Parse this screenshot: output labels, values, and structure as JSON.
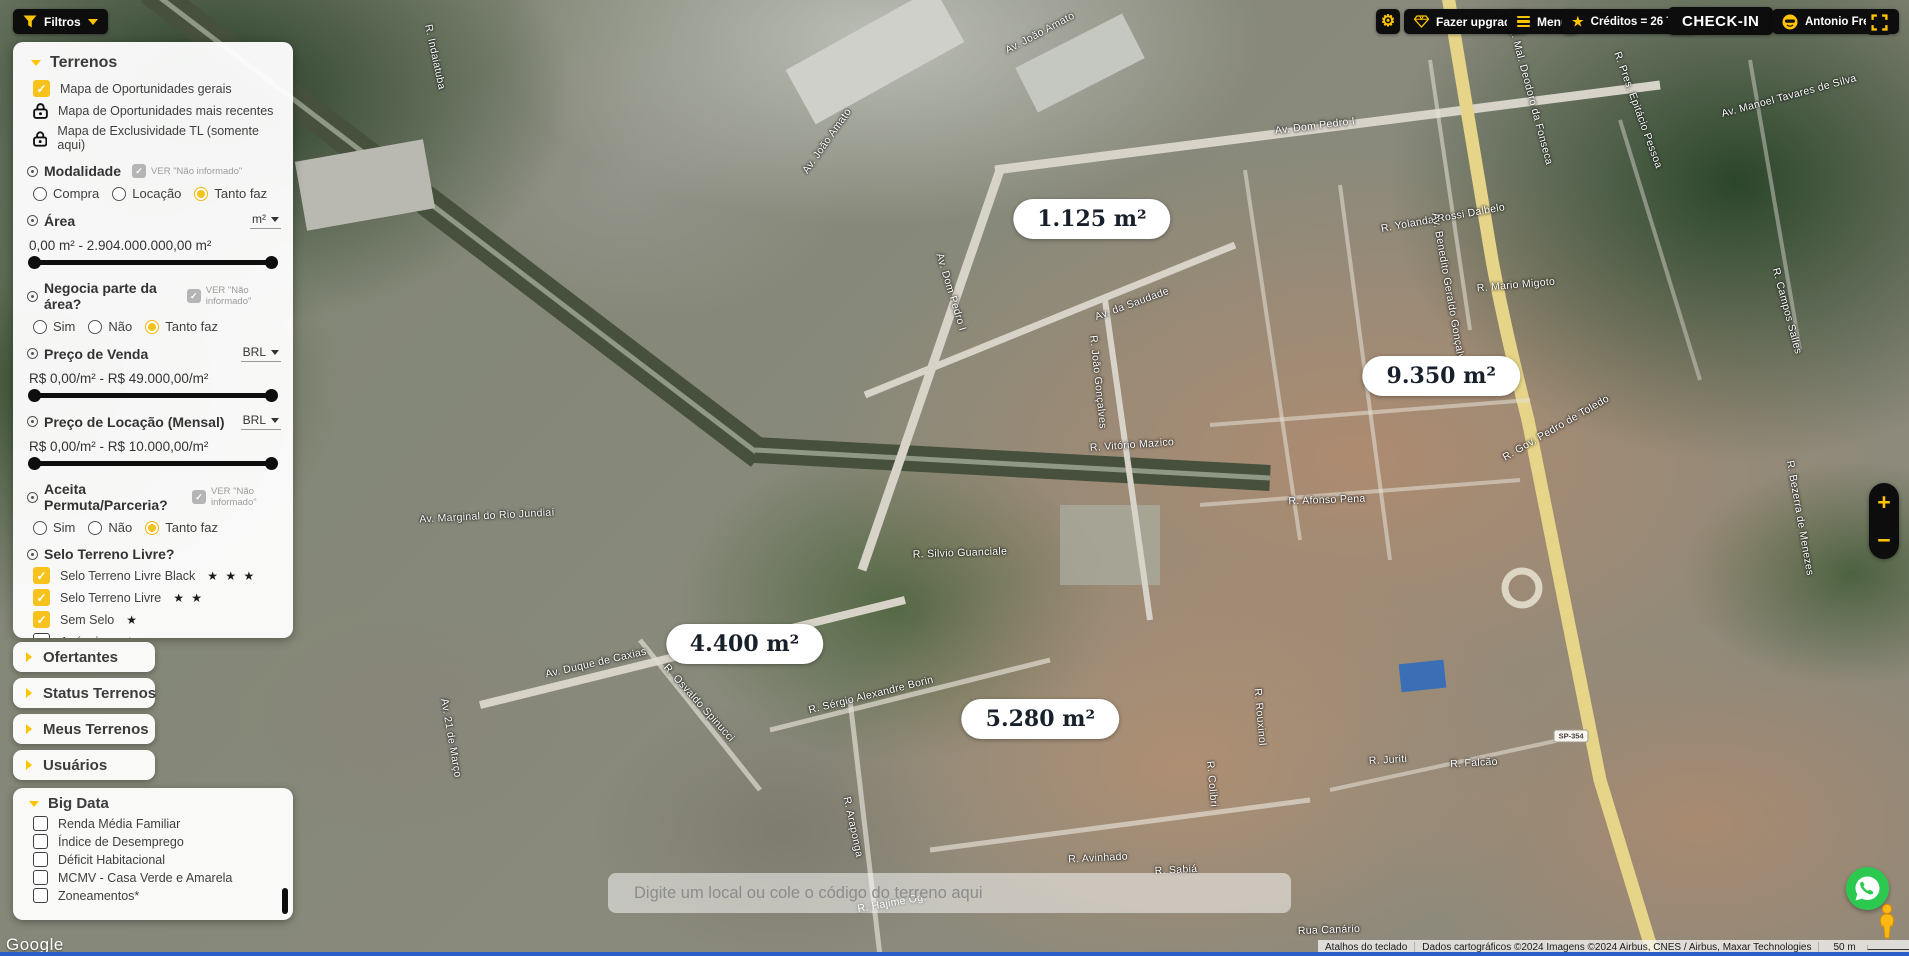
{
  "topbar": {
    "filtros_label": "Filtros",
    "fazer_upgrade_label": "Fazer upgrade",
    "menu_label": "Menu",
    "creditos_label": "Créditos = 26 TLs",
    "checkin_label": "CHECK-IN",
    "user_name": "Antonio Freitas"
  },
  "filters_panel": {
    "title": "Terrenos",
    "map_layers": [
      "Mapa de Oportunidades gerais",
      "Mapa de Oportunidades mais recentes",
      "Mapa de Exclusividade TL (somente aqui)"
    ],
    "ver_nao_informado_label": "VER \"Não informado\"",
    "modalidade": {
      "title": "Modalidade",
      "opt1": "Compra",
      "opt2": "Locação",
      "opt3": "Tanto faz",
      "selected": "Tanto faz"
    },
    "area": {
      "title": "Área",
      "unit": "m²",
      "range": "0,00 m² - 2.904.000.000,00 m²"
    },
    "negocia": {
      "title": "Negocia parte da área?",
      "opt1": "Sim",
      "opt2": "Não",
      "opt3": "Tanto faz",
      "selected": "Tanto faz"
    },
    "preco_venda": {
      "title": "Preço de Venda",
      "currency": "BRL",
      "range": "R$ 0,00/m² - R$ 49.000,00/m²"
    },
    "preco_locacao": {
      "title": "Preço de Locação (Mensal)",
      "currency": "BRL",
      "range": "R$ 0,00/m² - R$ 10.000,00/m²"
    },
    "permuta": {
      "title": "Aceita Permuta/Parceria?",
      "opt1": "Sim",
      "opt2": "Não",
      "opt3": "Tanto faz",
      "selected": "Tanto faz"
    },
    "selo": {
      "title": "Selo Terreno Livre?",
      "opt_black": "Selo Terreno Livre Black",
      "stars_black": "★ ★ ★",
      "opt_livre": "Selo Terreno Livre",
      "stars_livre": "★ ★",
      "opt_sem": "Sem Selo",
      "stars_sem": "★",
      "opt_externos": "Anúncios externos"
    }
  },
  "accordions": {
    "a1": "Ofertantes",
    "a2": "Status Terrenos",
    "a3": "Meus Terrenos",
    "a4": "Usuários"
  },
  "big_data": {
    "title": "Big Data",
    "i1": "Renda Média Familiar",
    "i2": "Índice de Desemprego",
    "i3": "Déficit Habitacional",
    "i4": "MCMV - Casa Verde e Amarela",
    "i5": "Zoneamentos*"
  },
  "map": {
    "area_labels": [
      {
        "text": "1.125 m²",
        "x": 57.2,
        "y": 22.9
      },
      {
        "text": "9.350 m²",
        "x": 75.5,
        "y": 39.3
      },
      {
        "text": "4.400 m²",
        "x": 39.0,
        "y": 67.4
      },
      {
        "text": "5.280 m²",
        "x": 54.5,
        "y": 75.2
      }
    ],
    "road_labels": [
      {
        "text": "Av. João Amato",
        "x": 54.5,
        "y": 3.5,
        "rot": -28
      },
      {
        "text": "Av. João Amato",
        "x": 43.3,
        "y": 14.8,
        "rot": -55
      },
      {
        "text": "R. Indaiatuba",
        "x": 22.8,
        "y": 6.0,
        "rot": 78
      },
      {
        "text": "Av. Dom Pedro I",
        "x": 68.9,
        "y": 13.2,
        "rot": -7
      },
      {
        "text": "Av. Dom Pedro I",
        "x": 49.8,
        "y": 30.5,
        "rot": 73
      },
      {
        "text": "R. Yolanda Rossi Dalbelo",
        "x": 75.6,
        "y": 22.8,
        "rot": -10
      },
      {
        "text": "R. Mario Migoto",
        "x": 79.4,
        "y": 29.8,
        "rot": -5
      },
      {
        "text": "Av. da Saudade",
        "x": 59.3,
        "y": 31.8,
        "rot": -20
      },
      {
        "text": "R. João Gonçalves",
        "x": 57.5,
        "y": 40.0,
        "rot": 84
      },
      {
        "text": "R. Vitório Mazico",
        "x": 59.3,
        "y": 46.5,
        "rot": -4
      },
      {
        "text": "Av. Marginal do Rio Jundiaí",
        "x": 25.5,
        "y": 54.0,
        "rot": -3
      },
      {
        "text": "Av. Benedito Geraldo Gonçalves",
        "x": 75.9,
        "y": 30.5,
        "rot": 80
      },
      {
        "text": "R. Afonso Pena",
        "x": 69.5,
        "y": 52.3,
        "rot": -2
      },
      {
        "text": "R. Silvio Guanciale",
        "x": 50.3,
        "y": 57.8,
        "rot": -2
      },
      {
        "text": "Av. Duque de Caxias",
        "x": 31.2,
        "y": 69.3,
        "rot": -13
      },
      {
        "text": "R. Osvaldo Spinucci",
        "x": 36.6,
        "y": 73.5,
        "rot": 48
      },
      {
        "text": "R. Sérgio Alexandre Borin",
        "x": 45.6,
        "y": 72.7,
        "rot": -14
      },
      {
        "text": "Av. 21 de Março",
        "x": 23.6,
        "y": 77.2,
        "rot": 80
      },
      {
        "text": "R. Araponga",
        "x": 44.7,
        "y": 86.5,
        "rot": 78
      },
      {
        "text": "R. Avinhado",
        "x": 57.5,
        "y": 89.8,
        "rot": -3
      },
      {
        "text": "R. Sabiá",
        "x": 61.6,
        "y": 91.0,
        "rot": -3
      },
      {
        "text": "R. Juriti",
        "x": 72.7,
        "y": 79.5,
        "rot": -3
      },
      {
        "text": "R. Falcão",
        "x": 77.2,
        "y": 79.8,
        "rot": -3
      },
      {
        "text": "Rua Canário",
        "x": 69.6,
        "y": 97.3,
        "rot": -2
      },
      {
        "text": "R. Hajime Og.",
        "x": 46.7,
        "y": 94.5,
        "rot": -10
      },
      {
        "text": "R. Rouxinol",
        "x": 66.0,
        "y": 75.0,
        "rot": 85
      },
      {
        "text": "R. Colibri",
        "x": 63.5,
        "y": 82.0,
        "rot": 85
      },
      {
        "text": "R. Gov. Pedro de Toledo",
        "x": 81.5,
        "y": 44.8,
        "rot": -30
      },
      {
        "text": "R. Bezerra de Menezes",
        "x": 94.3,
        "y": 54.2,
        "rot": 80
      },
      {
        "text": "R. Campos Salles",
        "x": 93.6,
        "y": 32.5,
        "rot": 75
      },
      {
        "text": "Av. Manoel Tavares de Silva",
        "x": 93.7,
        "y": 10.0,
        "rot": -15
      },
      {
        "text": "R. Pres. Epitácio Pessoa",
        "x": 85.8,
        "y": 11.5,
        "rot": 70
      },
      {
        "text": "R. Mal. Deodoro da Fonseca",
        "x": 80.2,
        "y": 10.0,
        "rot": 75
      }
    ],
    "shield": "SP-354",
    "search_placeholder": "Digite um local ou cole o código do terreno aqui",
    "google_logo": "Google",
    "attribution": {
      "shortcuts": "Atalhos do teclado",
      "data": "Dados cartográficos ©2024 Imagens ©2024 Airbus, CNES / Airbus, Maxar Technologies",
      "scale": "50 m",
      "terms": "Termos",
      "report": "Informar erro no mapa"
    }
  },
  "zoom_control": {
    "zoom_in": "+",
    "zoom_out": "−"
  },
  "colors": {
    "brand_yellow": "#FFC400",
    "checkbox_yellow": "#F6C21B",
    "whatsapp_green": "#2BC94F",
    "bottom_strip_blue": "#2C5EC9"
  }
}
